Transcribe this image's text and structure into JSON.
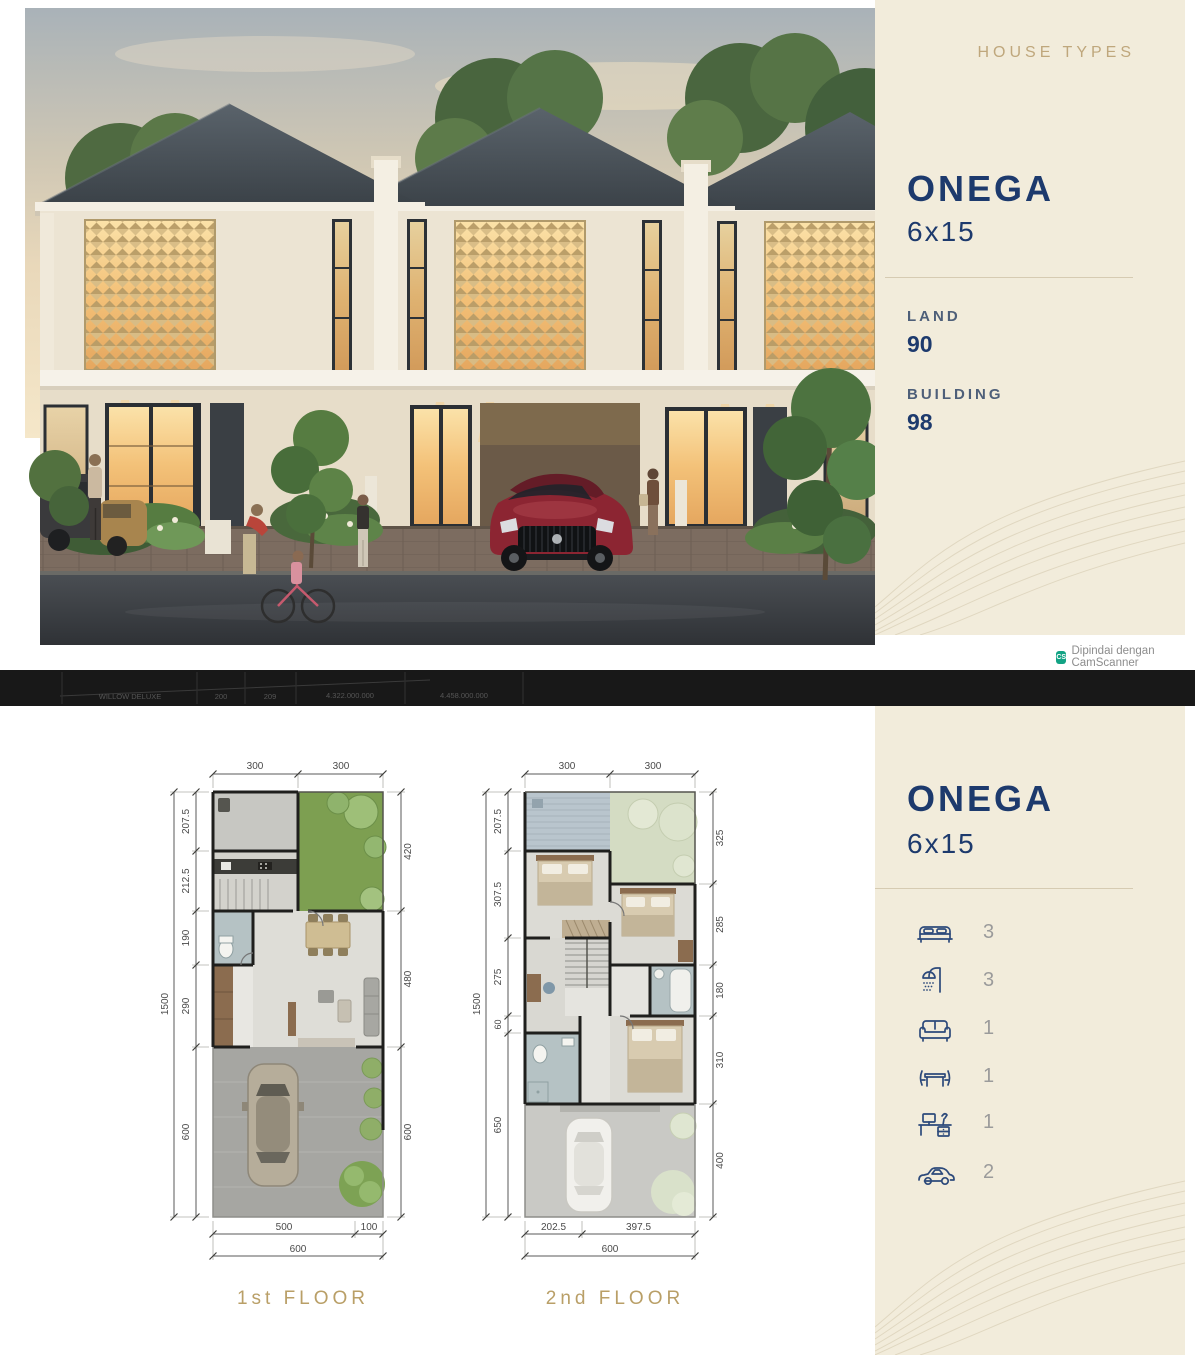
{
  "page": {
    "scan_badge_text": "Dipindai dengan CamScanner",
    "scan_badge_icon": "CS"
  },
  "hero": {
    "section_label": "HOUSE TYPES",
    "title": "ONEGA",
    "size": "6x15",
    "land_label": "LAND",
    "land_value": "90",
    "building_label": "BUILDING",
    "building_value": "98"
  },
  "table_strip": {
    "name": "WILLOW DELUXE",
    "land": "200",
    "building": "209",
    "price1": "4.322.000.000",
    "price2": "4.458.000.000"
  },
  "plans": {
    "title": "ONEGA",
    "size": "6x15",
    "features": [
      {
        "icon": "bed-icon",
        "count": "3"
      },
      {
        "icon": "shower-icon",
        "count": "3"
      },
      {
        "icon": "sofa-icon",
        "count": "1"
      },
      {
        "icon": "dining-table-icon",
        "count": "1"
      },
      {
        "icon": "desk-icon",
        "count": "1"
      },
      {
        "icon": "car-icon",
        "count": "2"
      }
    ],
    "first_floor": {
      "label": "1st FLOOR",
      "top_dims": [
        "300",
        "300"
      ],
      "left_total": "1500",
      "left_dims": [
        "207.5",
        "212.5",
        "190",
        "290",
        "600"
      ],
      "right_dims": [
        "420",
        "480",
        "600"
      ],
      "bottom_dims": [
        "500",
        "100"
      ],
      "bottom_total": "600"
    },
    "second_floor": {
      "label": "2nd FLOOR",
      "top_dims": [
        "300",
        "300"
      ],
      "left_total": "1500",
      "left_dims": [
        "207.5",
        "307.5",
        "275",
        "60",
        "650"
      ],
      "right_dims": [
        "325",
        "285",
        "180",
        "310",
        "400"
      ],
      "bottom_dims": [
        "202.5",
        "397.5"
      ],
      "bottom_total": "600"
    }
  },
  "colors": {
    "cream": "#f2ecdb",
    "navy": "#1d3a6d",
    "gold": "#bfa77c",
    "floor_label_gold": "#b99f67",
    "roof": "#3b4248",
    "garden_green": "#7d9f51",
    "car_red": "#8c2532"
  }
}
